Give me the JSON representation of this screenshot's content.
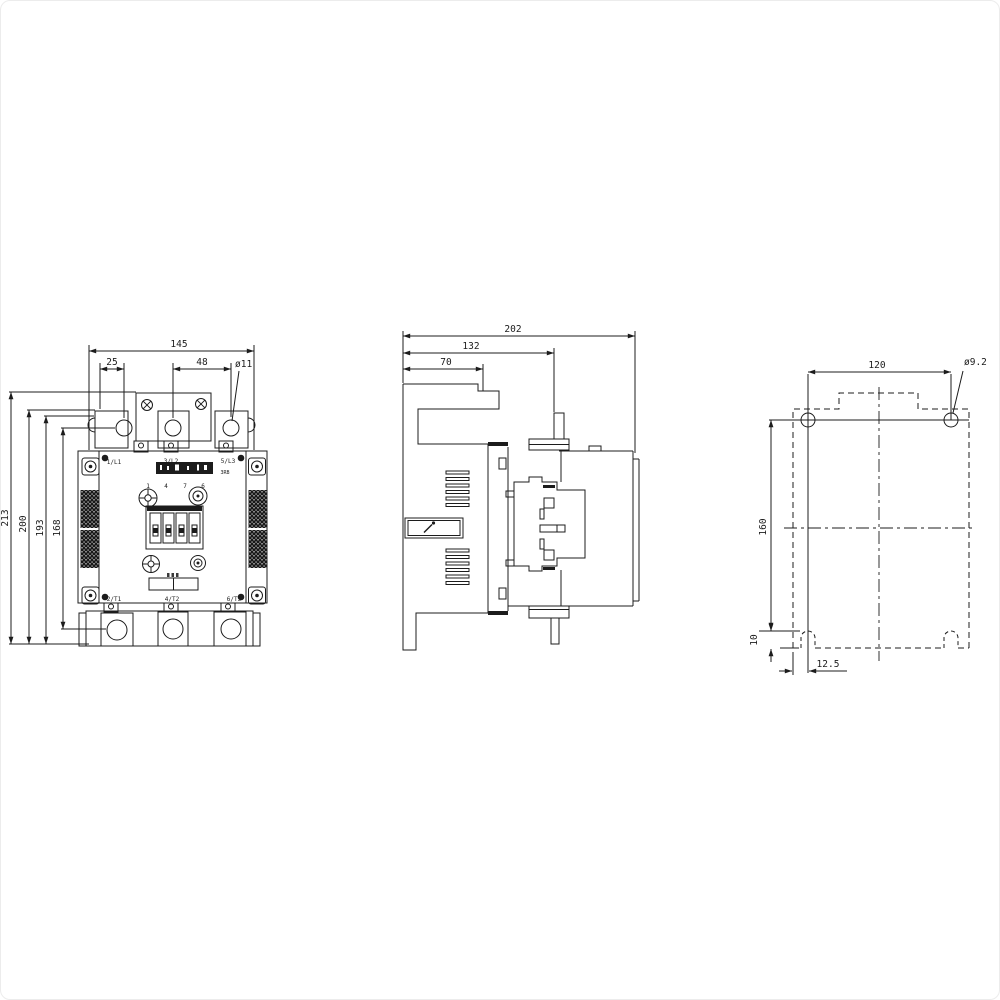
{
  "meta": {
    "background_color": "#ffffff",
    "line_color": "#1c1c1c"
  },
  "front_view": {
    "dims": {
      "width_total": "145",
      "width_left": "25",
      "width_right": "48",
      "hole_dia": "ø11",
      "height_total": "213",
      "height_b": "200",
      "height_c": "193",
      "height_d": "168"
    },
    "terminals_top": [
      "1/L1",
      "3/L2",
      "5/L3"
    ],
    "terminals_bottom": [
      "2/T1",
      "4/T2",
      "6/T3"
    ],
    "coil_terminal_numbers": [
      "1",
      "4",
      "7",
      "6"
    ],
    "type_code": "3RB"
  },
  "side_view": {
    "dims": {
      "depth_total": "202",
      "depth_b": "132",
      "depth_c": "70"
    }
  },
  "footprint_view": {
    "dims": {
      "hole_spacing": "120",
      "hole_dia": "ø9.2",
      "vertical_spacing": "160",
      "slot_depth": "10",
      "slot_offset": "12.5"
    }
  }
}
